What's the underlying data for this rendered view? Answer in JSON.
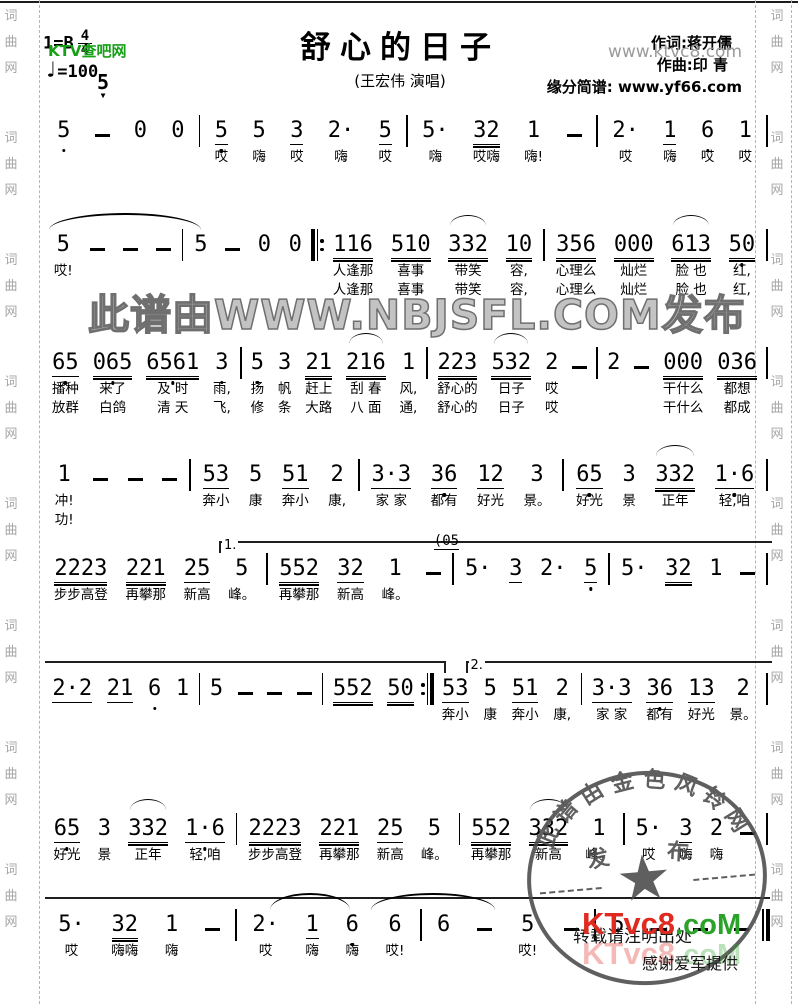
{
  "header": {
    "key": "1=B",
    "meter_num": "4",
    "meter_den": "4",
    "tempo_glyph": "♩",
    "tempo": "=100",
    "range_note": "5",
    "range_arrow": "▼",
    "title": "舒心的日子",
    "subtitle": "(王宏伟 演唱)",
    "lyricist": "作词:蒋开儒",
    "composer": "作曲:印 青",
    "source": "缘分简谱: www.yf66.com"
  },
  "watermarks": {
    "ktv_green": "KTV查吧网",
    "ktvc8_gray": "www.ktvc8.com",
    "nbjsfl": "此谱由WWW.NBJSFL.COM发布",
    "stamp_arc": [
      "此",
      "谱",
      "由",
      "金",
      "色",
      "风",
      "铃",
      "网"
    ],
    "stamp_fa": "发",
    "stamp_bu": "布",
    "stamp_star": "★",
    "logo_red": "KTvc8",
    "logo_green": ".coM",
    "reprint_note": "转载请注明出处",
    "thanks": "感谢爱军提供"
  },
  "sidebar": {
    "chars": [
      "词",
      "曲",
      "网"
    ],
    "groups": 8
  },
  "systems": [
    {
      "cells": [
        {
          "n": "5",
          "d": 1
        },
        {
          "n": "–"
        },
        {
          "n": "0"
        },
        {
          "n": "0"
        },
        {
          "b": "|"
        },
        {
          "n": "5",
          "u": 1,
          "d": 1,
          "l1": "哎"
        },
        {
          "n": "5",
          "l1": "嗨"
        },
        {
          "n": "3",
          "u": 1,
          "l1": "哎"
        },
        {
          "n": "2·",
          "l1": "嗨"
        },
        {
          "n": "5",
          "u": 1,
          "l1": "哎"
        },
        {
          "b": "|"
        },
        {
          "n": "5·",
          "l1": "嗨"
        },
        {
          "n": "32",
          "u": 2,
          "l1": "哎嗨"
        },
        {
          "n": "1",
          "l1": "嗨!"
        },
        {
          "n": "–"
        },
        {
          "b": "|"
        },
        {
          "n": "2·",
          "l1": "哎"
        },
        {
          "n": "1",
          "u": 1,
          "l1": "嗨"
        },
        {
          "n": "6",
          "d": 1,
          "l1": "哎"
        },
        {
          "n": "1",
          "l1": "哎"
        },
        {
          "b": "|"
        }
      ]
    },
    {
      "slurs": [
        {
          "l": 0.5,
          "w": 21
        }
      ],
      "cells": [
        {
          "n": "5",
          "l1": "哎!"
        },
        {
          "n": "–"
        },
        {
          "n": "–"
        },
        {
          "n": "–"
        },
        {
          "b": "|"
        },
        {
          "n": "5"
        },
        {
          "n": "–"
        },
        {
          "n": "0"
        },
        {
          "n": "0"
        },
        {
          "b": "b"
        },
        {
          "n": "116",
          "u": 2,
          "l1": "人逢那",
          "l2": "人逢那"
        },
        {
          "n": "510",
          "u": 2,
          "l1": "喜事",
          "l2": "喜事"
        },
        {
          "n": "332",
          "u": 2,
          "a": 1,
          "l1": "带笑",
          "l2": "带笑"
        },
        {
          "n": "10",
          "u": 2,
          "l1": "容,",
          "l2": "容,"
        },
        {
          "b": "|"
        },
        {
          "n": "356",
          "u": 2,
          "l1": "心理么",
          "l2": "心理么"
        },
        {
          "n": "000",
          "u": 2,
          "l1": "灿烂",
          "l2": "灿烂"
        },
        {
          "n": "613",
          "u": 2,
          "a": 1,
          "l1": "脸 也",
          "l2": "脸 也"
        },
        {
          "n": "50",
          "u": 2,
          "d": 1,
          "l1": "红,",
          "l2": "红,"
        },
        {
          "b": "|"
        }
      ]
    },
    {
      "cells": [
        {
          "n": "65",
          "u": 1,
          "d": 1,
          "l1": "播种",
          "l2": "放群"
        },
        {
          "n": "065",
          "u": 2,
          "d": 1,
          "l1": "来了",
          "l2": "白鸽"
        },
        {
          "n": "6561",
          "u": 2,
          "d": 1,
          "l1": "及 时",
          "l2": "清 天"
        },
        {
          "n": "3",
          "d": 1,
          "l1": "雨,",
          "l2": "飞,"
        },
        {
          "b": "|"
        },
        {
          "n": "5",
          "d": 1,
          "l1": "扬",
          "l2": "修"
        },
        {
          "n": "3",
          "l1": "帆",
          "l2": "条"
        },
        {
          "n": "21",
          "u": 2,
          "l1": "赶上",
          "l2": "大路"
        },
        {
          "n": "216",
          "u": 2,
          "a": 1,
          "l1": "刮 春",
          "l2": "八 面"
        },
        {
          "n": "1",
          "l1": "风,",
          "l2": "通,"
        },
        {
          "b": "|"
        },
        {
          "n": "223",
          "u": 2,
          "l1": "舒心的",
          "l2": "舒心的"
        },
        {
          "n": "532",
          "u": 2,
          "a": 1,
          "l1": "日子",
          "l2": "日子"
        },
        {
          "n": "2",
          "l1": "哎",
          "l2": "哎"
        },
        {
          "n": "–"
        },
        {
          "b": "|"
        },
        {
          "n": "2"
        },
        {
          "n": "–"
        },
        {
          "n": "000",
          "u": 2,
          "l1": "干什么",
          "l2": "干什么"
        },
        {
          "n": "036",
          "u": 2,
          "l1": "都想",
          "l2": "都成"
        },
        {
          "b": "|"
        }
      ]
    },
    {
      "cells": [
        {
          "n": "1",
          "l1": "冲!",
          "l2": "功!"
        },
        {
          "n": "–"
        },
        {
          "n": "–"
        },
        {
          "n": "–"
        },
        {
          "b": "|"
        },
        {
          "n": "53",
          "u": 1,
          "l1": "奔小"
        },
        {
          "n": "5",
          "l1": "康"
        },
        {
          "n": "51",
          "u": 1,
          "l1": "奔小"
        },
        {
          "n": "2",
          "l1": "康,"
        },
        {
          "b": "|"
        },
        {
          "n": "3·3",
          "u": 1,
          "l1": "家 家"
        },
        {
          "n": "36",
          "u": 1,
          "d": 1,
          "l1": "都有"
        },
        {
          "n": "12",
          "u": 1,
          "l1": "好光"
        },
        {
          "n": "3",
          "l1": "景。"
        },
        {
          "b": "|"
        },
        {
          "n": "65",
          "u": 1,
          "d": 1,
          "l1": "好光"
        },
        {
          "n": "3",
          "l1": "景"
        },
        {
          "n": "332",
          "u": 2,
          "a": 1,
          "l1": "正年"
        },
        {
          "n": "1·6",
          "u": 1,
          "d": 1,
          "l1": "轻,咱"
        },
        {
          "b": "|"
        }
      ]
    },
    {
      "voltas": [
        {
          "label": "1.",
          "l": 24,
          "w": 76,
          "lt": 1
        }
      ],
      "cells": [
        {
          "n": "2223",
          "u": 2,
          "l1": "步步高登"
        },
        {
          "n": "221",
          "u": 2,
          "l1": "再攀那"
        },
        {
          "n": "25",
          "u": 1,
          "l1": "新高"
        },
        {
          "n": "5",
          "l1": "峰。"
        },
        {
          "b": "|"
        },
        {
          "n": "552",
          "u": 2,
          "l1": "再攀那"
        },
        {
          "n": "32",
          "u": 1,
          "l1": "新高"
        },
        {
          "n": "1",
          "l1": "峰。"
        },
        {
          "n": "–",
          "s": "(05"
        },
        {
          "b": "|"
        },
        {
          "n": "5·"
        },
        {
          "n": "3",
          "u": 1
        },
        {
          "n": "2·"
        },
        {
          "n": "5",
          "u": 1,
          "d": 1
        },
        {
          "b": "|"
        },
        {
          "n": "5·"
        },
        {
          "n": "32",
          "u": 2
        },
        {
          "n": "1"
        },
        {
          "n": "–"
        },
        {
          "b": "|"
        }
      ]
    },
    {
      "voltas": [
        {
          "label": "",
          "l": 0,
          "w": 55,
          "rt": 1
        },
        {
          "label": "2.",
          "l": 58,
          "w": 42,
          "lt": 1
        }
      ],
      "cells": [
        {
          "n": "2·2",
          "u": 1
        },
        {
          "n": "21",
          "u": 1
        },
        {
          "n": "6",
          "d": 1
        },
        {
          "n": "1"
        },
        {
          "b": "|"
        },
        {
          "n": "5"
        },
        {
          "n": "–"
        },
        {
          "n": "–"
        },
        {
          "n": "–"
        },
        {
          "b": "|"
        },
        {
          "n": "552",
          "u": 2
        },
        {
          "n": "50",
          "u": 2
        },
        {
          "b": "e"
        },
        {
          "n": "53",
          "u": 1,
          "l1": "奔小"
        },
        {
          "n": "5",
          "l1": "康"
        },
        {
          "n": "51",
          "u": 1,
          "l1": "奔小"
        },
        {
          "n": "2",
          "l1": "康,"
        },
        {
          "b": "|"
        },
        {
          "n": "3·3",
          "u": 1,
          "l1": "家 家"
        },
        {
          "n": "36",
          "u": 1,
          "d": 1,
          "l1": "都有"
        },
        {
          "n": "13",
          "u": 1,
          "l1": "好光"
        },
        {
          "n": "2",
          "l1": "景。"
        },
        {
          "b": "|"
        }
      ]
    },
    {
      "cells": [
        {
          "n": "65",
          "u": 1,
          "d": 1,
          "l1": "好光"
        },
        {
          "n": "3",
          "l1": "景"
        },
        {
          "n": "332",
          "u": 2,
          "a": 1,
          "l1": "正年"
        },
        {
          "n": "1·6",
          "u": 1,
          "d": 1,
          "l1": "轻,咱"
        },
        {
          "b": "|"
        },
        {
          "n": "2223",
          "u": 2,
          "l1": "步步高登"
        },
        {
          "n": "221",
          "u": 2,
          "l1": "再攀那"
        },
        {
          "n": "25",
          "u": 1,
          "l1": "新高"
        },
        {
          "n": "5",
          "l1": "峰。"
        },
        {
          "b": "|"
        },
        {
          "n": "552",
          "u": 2,
          "l1": "再攀那"
        },
        {
          "n": "332",
          "u": 2,
          "a": 1,
          "l1": "新高"
        },
        {
          "n": "1",
          "l1": "峰。"
        },
        {
          "b": "|"
        },
        {
          "n": "5·",
          "l1": "哎"
        },
        {
          "n": "3",
          "u": 1,
          "l1": "嗨"
        },
        {
          "n": "2",
          "l1": "嗨"
        },
        {
          "n": "–"
        },
        {
          "b": "|"
        }
      ]
    },
    {
      "voltas": [
        {
          "label": "",
          "l": 0,
          "w": 100
        }
      ],
      "slurs": [
        {
          "l": 31,
          "w": 11
        },
        {
          "l": 45,
          "w": 17
        }
      ],
      "cells": [
        {
          "n": "5·",
          "l1": "哎"
        },
        {
          "n": "32",
          "u": 2,
          "l1": "嗨嗨"
        },
        {
          "n": "1",
          "l1": "嗨"
        },
        {
          "n": "–"
        },
        {
          "b": "|"
        },
        {
          "n": "2·",
          "l1": "哎"
        },
        {
          "n": "1",
          "u": 1,
          "l1": "嗨"
        },
        {
          "n": "6",
          "d": 1,
          "l1": "嗨"
        },
        {
          "n": "6",
          "l1": "哎!"
        },
        {
          "b": "|"
        },
        {
          "n": "6"
        },
        {
          "n": "–"
        },
        {
          "n": "5",
          "l1": "哎!"
        },
        {
          "n": "–"
        },
        {
          "b": "|"
        },
        {
          "n": "5"
        },
        {
          "n": "–"
        },
        {
          "n": "–"
        },
        {
          "n": "–"
        },
        {
          "b": "f"
        }
      ]
    }
  ]
}
